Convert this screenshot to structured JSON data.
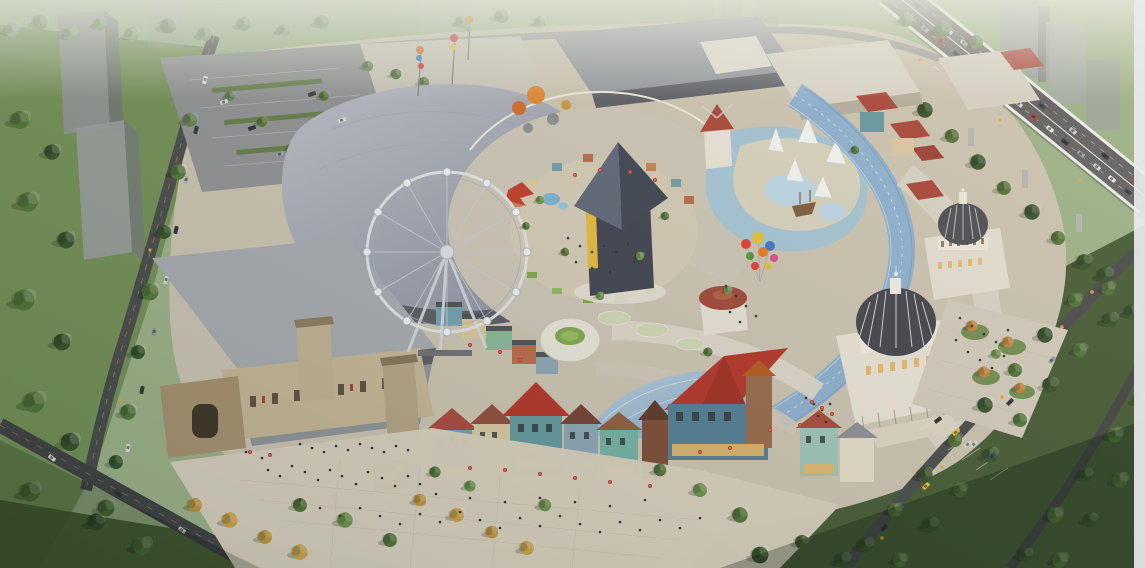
{
  "scene": {
    "description": "Aerial dusk rendering of a large open-air shopping mall: ferris wheel, central pyramid pavilion inside a circular court, wavy blue glass canopy ribbon, two classical domed halls, colorful European-style shop houses, stone entrance gate with LED billboard, plazas with crowds, tree-lined avenues, parking lots and an elevated highway full of traffic on the right."
  },
  "palette": {
    "base_green": "#9bb289",
    "lawn_left": "#6f8d53",
    "lawn_dark": "#3d5430",
    "grass_light": "#a9bf94",
    "site_paving": "#cbc4b4",
    "plaza": "#d8d0c0",
    "roof_gray_light": "#a6abb4",
    "roof_gray": "#8f95a1",
    "roof_dark": "#575c66",
    "roof_cream": "#cbc6ba",
    "roof_white": "#e2dfd6",
    "red_roof": "#a8433a",
    "red_roof_bright": "#b23228",
    "rust_roof": "#b55a30",
    "glass_blue": "#86aed6",
    "glass_light": "#b9d2ea",
    "dome_dark": "#3f414c",
    "stone": "#c6b697",
    "stone_dark": "#a5906f",
    "asphalt": "#46484c",
    "asphalt_light": "#97999c",
    "highway": "#5e6064",
    "water": "#9cc4de",
    "tree_dark": "#33502c",
    "tree_mid": "#4e7238",
    "tree_light": "#68924a",
    "tree_hazy": "#7f9a72",
    "tree_gold": "#bd9440",
    "tree_orange": "#c0823c",
    "people": "#2e3033",
    "umbrella_red": "#c23430",
    "lamp": "#f0a040",
    "led_red": "#b52c24",
    "ghost_tower": "#8e9398",
    "edge_strip": "#e9eaec"
  },
  "balloons": {
    "cluster_colors": [
      "#e43a2e",
      "#e8c030",
      "#3a72c8",
      "#4a9a3c",
      "#e87a22",
      "#d84a8a"
    ],
    "floating_colors": [
      "#d06a28",
      "#e08430",
      "#8a8d92",
      "#c89a40"
    ]
  }
}
